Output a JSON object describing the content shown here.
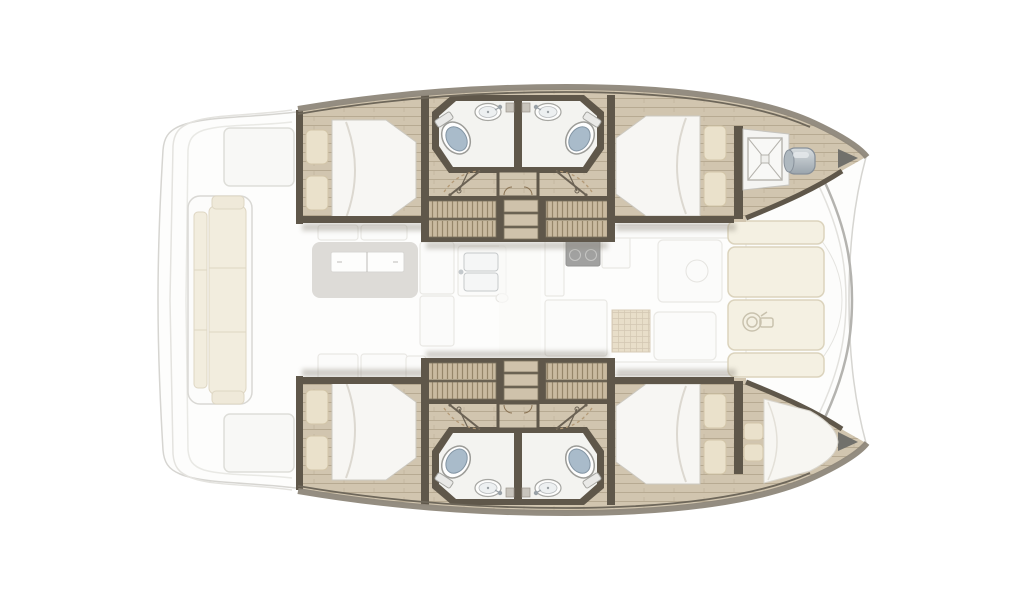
{
  "diagram": {
    "kind": "catamaran-floor-plan",
    "view": "top view, bow to the right",
    "visible_text": [],
    "features": {
      "double_cabins": 4,
      "bathrooms": 4,
      "toilets": 4,
      "sinks": 4,
      "wardrobes": 4,
      "companionway_steps": 2,
      "forepeak_berth": 1,
      "anchor_locker": 1,
      "windlass": 1,
      "salon_items": [
        "dining-table",
        "sofa-seats",
        "galley-double-sink",
        "stove",
        "counters",
        "grid-mat",
        "walkway"
      ],
      "aft_cockpit_items": [
        "bench-seat",
        "transom-steps",
        "engine-hatches"
      ],
      "fore_cockpit_items": [
        "sunpad-cushions",
        "winch"
      ]
    }
  },
  "colors": {
    "outline_faint": "#d6d5d1",
    "deck_white": "#fdfdfc",
    "platform_line": "#e4e3df",
    "hull_wood": "#d1c5af",
    "wood_line": "#b7aa92",
    "trim_dark": "#5f574a",
    "trim_mid": "#8e877a",
    "bath_floor": "#f3f3f0",
    "toilet_lid": "#a9bbca",
    "mattress": "#f7f6f3",
    "mattress_shade": "#dcd8d0",
    "pillow": "#eae1cb",
    "pillow_shade": "#d2c5a8",
    "wardrobe_base": "#c9baa0",
    "wardrobe_stripe": "#96866a",
    "step_tread": "#cfc2ab",
    "sunpad": "#f4f0e2",
    "sunpad_stroke": "#dbd3bc",
    "ghost_fill": "#fbfbf9",
    "ghost_stroke": "#d9d7d2",
    "table_gray": "#b7b3ac",
    "stove_dark": "#575755",
    "grid_mat": "#d7c5a1",
    "grid_line": "#b29c76",
    "windlass_hi": "#d8dde0",
    "windlass_lo": "#9aa4ac",
    "beam_stroke": "#b4b3af",
    "shadow": "#8f897d",
    "door_arc": "#b49a77",
    "door_leaf": "#6b6254"
  }
}
